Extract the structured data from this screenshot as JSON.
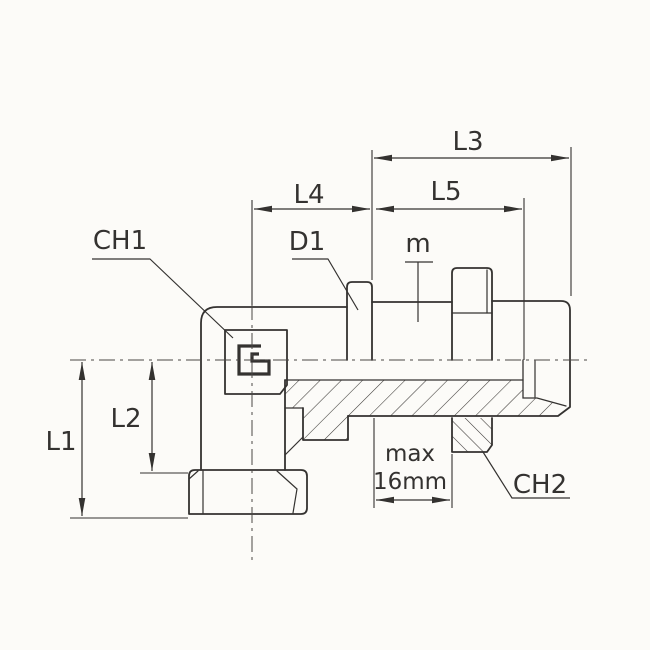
{
  "drawing": {
    "colors": {
      "line": "#343230",
      "centerline": "#4a4745",
      "background": "#fcfbf8"
    },
    "labels": {
      "l1": "L1",
      "l2": "L2",
      "l3": "L3",
      "l4": "L4",
      "l5": "L5",
      "ch1": "CH1",
      "ch2": "CH2",
      "d1": "D1",
      "m": "m",
      "max_line1": "max",
      "max_line2": "16mm"
    }
  }
}
